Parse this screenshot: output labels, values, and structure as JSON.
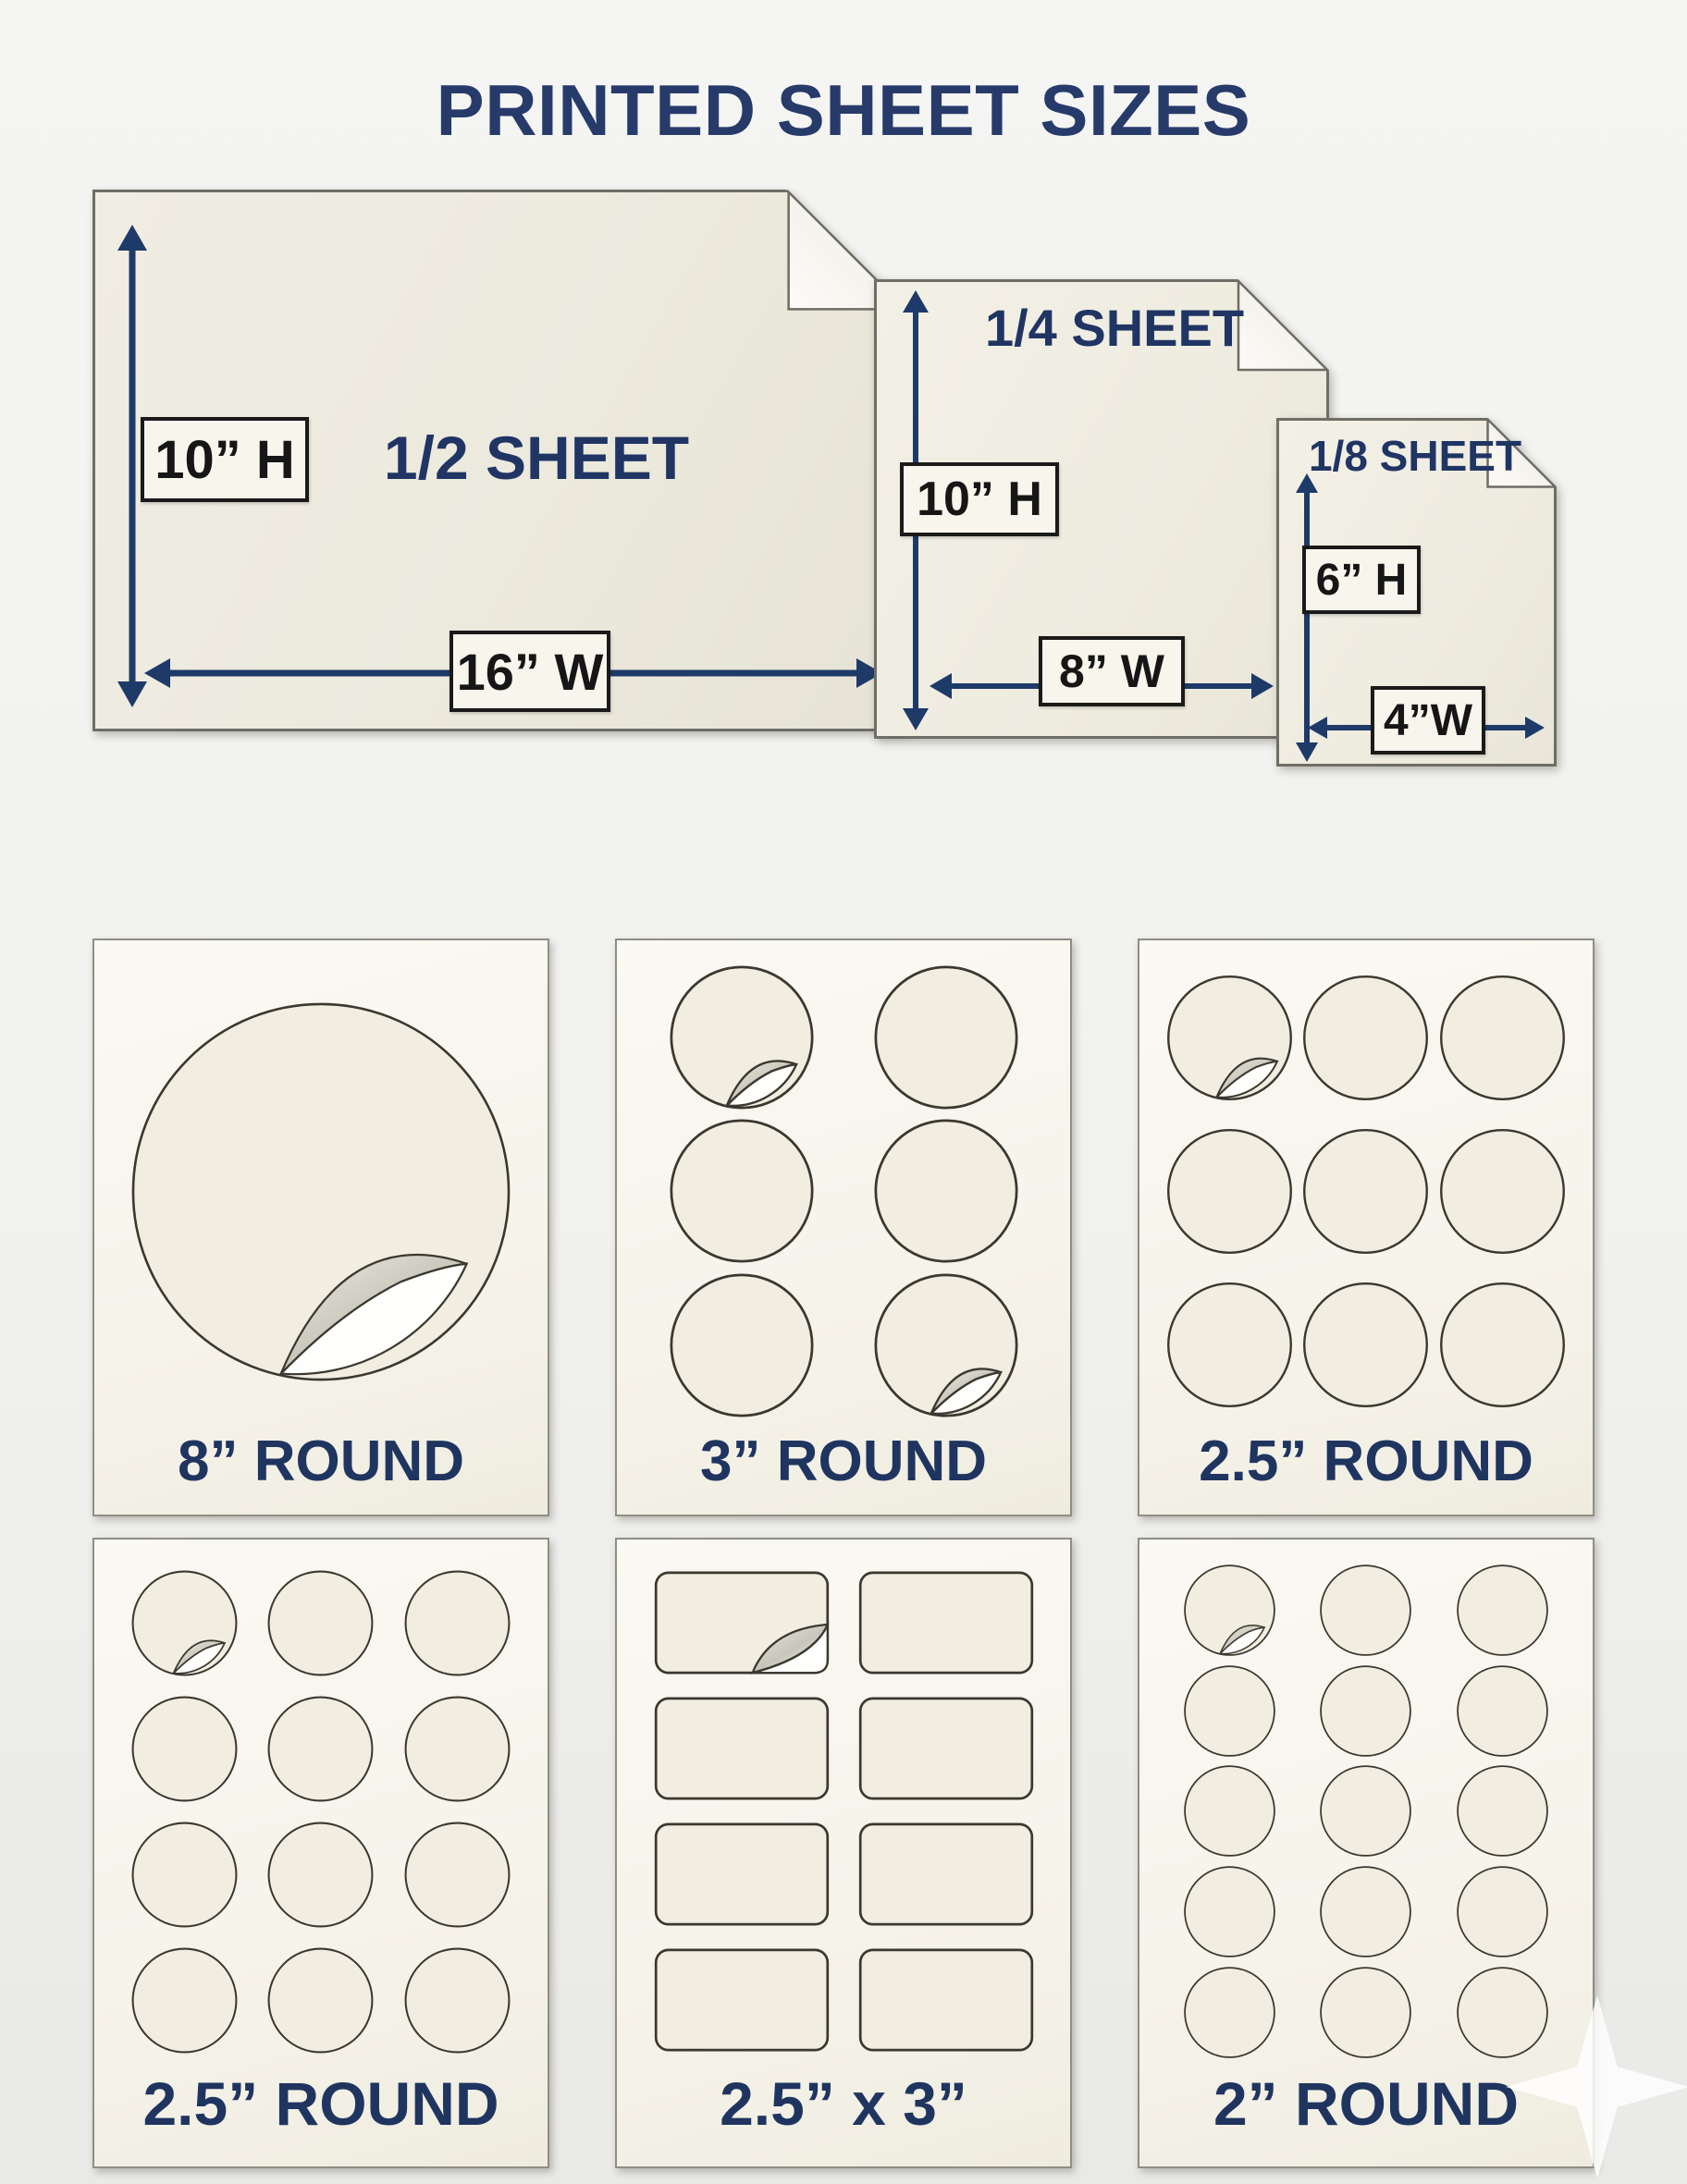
{
  "title": "PRINTED SHEET SIZES",
  "colors": {
    "navy_accent": "#1e3a68",
    "title_navy": "#273b6a",
    "paper_cream": "#eceadd",
    "sticker_cream": "#f1ede1",
    "dim_label_bg": "#f8f5ec",
    "dim_label_text": "#161616",
    "page_background": "#f1f1ef"
  },
  "size_sheets": [
    {
      "name": "1/2 SHEET",
      "height_label": "10” H",
      "width_label": "16” W"
    },
    {
      "name": "1/4 SHEET",
      "height_label": "10” H",
      "width_label": "8” W"
    },
    {
      "name": "1/8 SHEET",
      "height_label": "6” H",
      "width_label": "4”W"
    }
  ],
  "sticker_sheets": [
    {
      "label": "8” ROUND",
      "shape": "circle",
      "rows": 1,
      "cols": 1,
      "peeled": [
        0
      ],
      "big": true
    },
    {
      "label": "3” ROUND",
      "shape": "circle",
      "rows": 3,
      "cols": 2,
      "peeled": [
        0,
        5
      ]
    },
    {
      "label": "2.5” ROUND",
      "shape": "circle",
      "rows": 3,
      "cols": 3,
      "peeled": [
        0
      ]
    },
    {
      "label": "2.5” ROUND",
      "shape": "circle",
      "rows": 4,
      "cols": 3,
      "peeled": [
        0
      ]
    },
    {
      "label": "2.5” x 3”",
      "shape": "rect",
      "rows": 4,
      "cols": 2,
      "peeled": [
        0
      ]
    },
    {
      "label": "2” ROUND",
      "shape": "circle",
      "rows": 5,
      "cols": 3,
      "peeled": [
        0
      ]
    }
  ]
}
